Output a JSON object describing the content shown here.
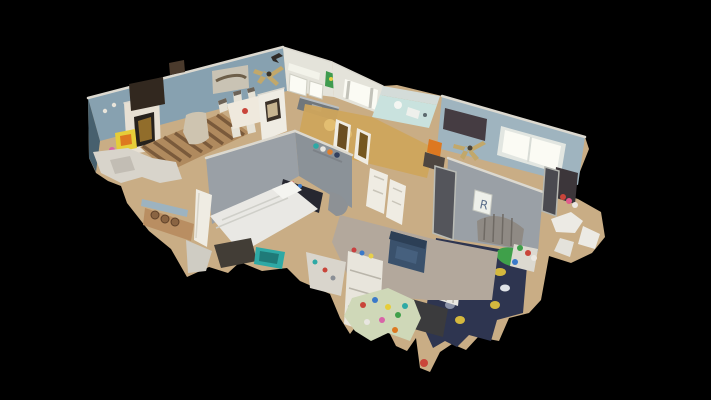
{
  "viewport": {
    "type": "3d-dollhouse-view"
  },
  "scene": {
    "rooms": [
      "living-room",
      "dining-area",
      "kitchen",
      "bathroom",
      "hallway",
      "master-bedroom",
      "nursery",
      "kids-room"
    ],
    "nursery": {
      "letter_sign": "R"
    }
  },
  "palette": {
    "background": "#000000",
    "cut_edge": "#dcd9d0",
    "wall_blue": "#87a1b0",
    "wall_blue_light": "#9fb4bf",
    "wall_dark": "#47606e",
    "wall_gray": "#9aa0a6",
    "wall_gray_dark": "#8b9298",
    "wall_white": "#e4e3da",
    "floor_wood": "#c9ad85",
    "floor_gray": "#b3a89c",
    "window_glow": "#fbfbf4",
    "hallway_glow": "#cfa55c",
    "bathroom_aqua": "#c9e2de",
    "stone": "#e7e0d3",
    "tv_dark": "#32281f",
    "firebox": "#26211c",
    "brass": "#a57a2e",
    "recliner": "#cec4b0",
    "rug_base": "#b08a5e",
    "rug_stripe": "#7a5a3b",
    "art_canvas": "#c9c3b4",
    "art_green": "#3f9b4f",
    "table_white": "#efe9dd",
    "bed_white": "#e9e8e4",
    "headboard_dark": "#262730",
    "rug_dark": "#423d36",
    "basket_teal": "#2ea9a5",
    "wood_brown": "#b98e62",
    "door_white": "#efece3",
    "crib_navy": "#2e3550",
    "camo_yellow": "#d4b83e",
    "camo_green": "#4c8c4a",
    "chair_navy": "#3a516c",
    "dresser_white": "#e8e5dc",
    "mat_green": "#cfd8b8",
    "toy_yellow": "#e6cd39",
    "toy_orange": "#dd7820",
    "toy_red": "#c9453a",
    "fan_tan": "#c2a86a",
    "clutter_light": "#d8d4cb",
    "board_dark": "#453c42"
  }
}
